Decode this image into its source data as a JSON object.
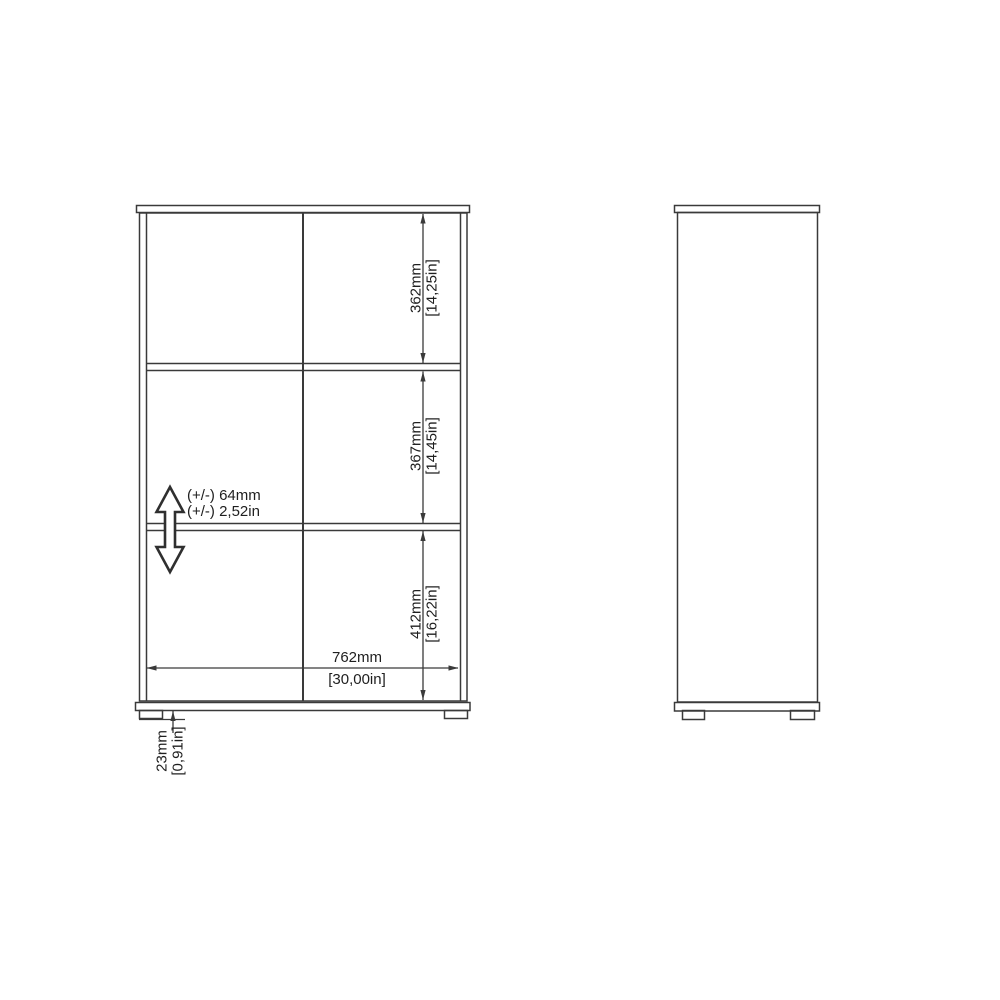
{
  "canvas": {
    "background": "#ffffff",
    "line_color": "#3a3a3a",
    "arrow_fill": "#3a3a3a",
    "text_color": "#1f1f1f"
  },
  "drawing": {
    "kind": "furniture-dimension-diagram",
    "views": {
      "front": "front-view",
      "side": "side-view"
    }
  },
  "dimensions": {
    "top_section": {
      "mm": "362mm",
      "inches": "[14,25in]"
    },
    "middle_section": {
      "mm": "367mm",
      "inches": "[14,45in]"
    },
    "bottom_section": {
      "mm": "412mm",
      "inches": "[16,22in]"
    },
    "overall_width": {
      "mm": "762mm",
      "inches": "[30,00in]"
    },
    "foot_height": {
      "mm": "23mm",
      "inches": "[0,91in]"
    },
    "shelf_adjustability": {
      "mm": "(+/-) 64mm",
      "inches": "(+/-) 2,52in"
    }
  }
}
